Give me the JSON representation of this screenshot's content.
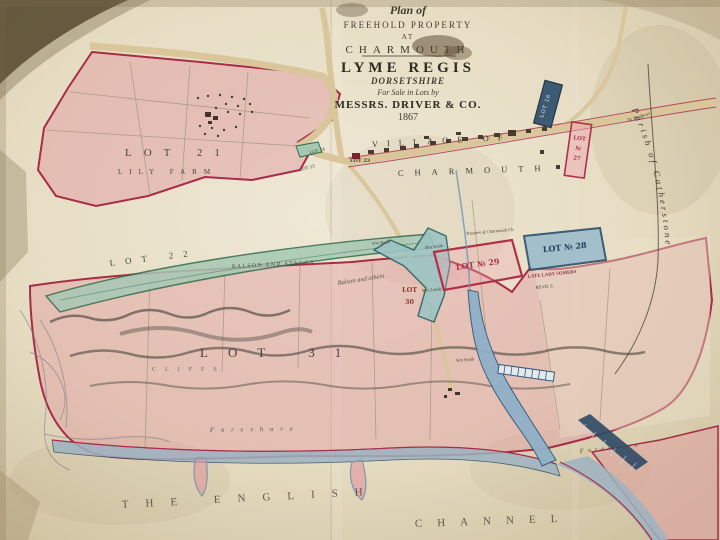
{
  "title_block": {
    "plan_of": "Plan of",
    "freehold": "FREEHOLD PROPERTY",
    "at": "AT",
    "charmouth": "CHARMOUTH",
    "lyme_regis": "LYME REGIS",
    "dorsetshire": "DORSETSHIRE",
    "for_sale": "For Sale in Lots by",
    "messrs": "MESSRS. DRIVER & CO.",
    "year": "1867"
  },
  "village": {
    "line1": "VILLAGE OF",
    "line2": "CHARMOUTH"
  },
  "lots": {
    "lot21": "LOT 21",
    "lot21_sub": "LILY FARM",
    "lot22": "LOT 22",
    "lot23": "LOT 23",
    "lot24": "LOT 24",
    "lot25": "LOT 25",
    "lot26": "LOT 26",
    "lot27_l1": "LOT",
    "lot27_l2": "№",
    "lot27_l3": "27",
    "lot28": "LOT № 28",
    "lot29": "LOT № 29",
    "lot30_l1": "LOT",
    "lot30_l2": "30",
    "lot31": "LOT 31"
  },
  "owners": {
    "balson_caps": "BALSON AND STAGGS",
    "balson_italic": "Balson and others",
    "wm_smith_a": "Wm Smith",
    "mrs_smith": "Mrs Smith",
    "wm_smith_b": "Wm Smith",
    "mrs_loude": "Mrs Loude",
    "trustees": "Trustees of Charmouth Ch.",
    "late_lady": "LATE LADY SOMERS",
    "revd": "REVD. E."
  },
  "geo": {
    "parish": "Parish of Catherstone",
    "to_bridport": "To Bridport",
    "cliffs": "CLIFFS",
    "foreshore_w": "Foreshore",
    "foreshore_e": "Foreshore",
    "sea_1": "THE ENGLISH",
    "sea_2": "CHANNEL"
  },
  "colors": {
    "paper": "#e9e1cb",
    "boundary_crimson": "#a82c48",
    "lot_green": "#a6c9b4",
    "lot_teal": "#9dc4c2",
    "lot_blue": "#9cbcca",
    "road_tan": "#d9c69b",
    "river_blue": "#8fb0c8",
    "ink_dark": "#3e382e"
  }
}
